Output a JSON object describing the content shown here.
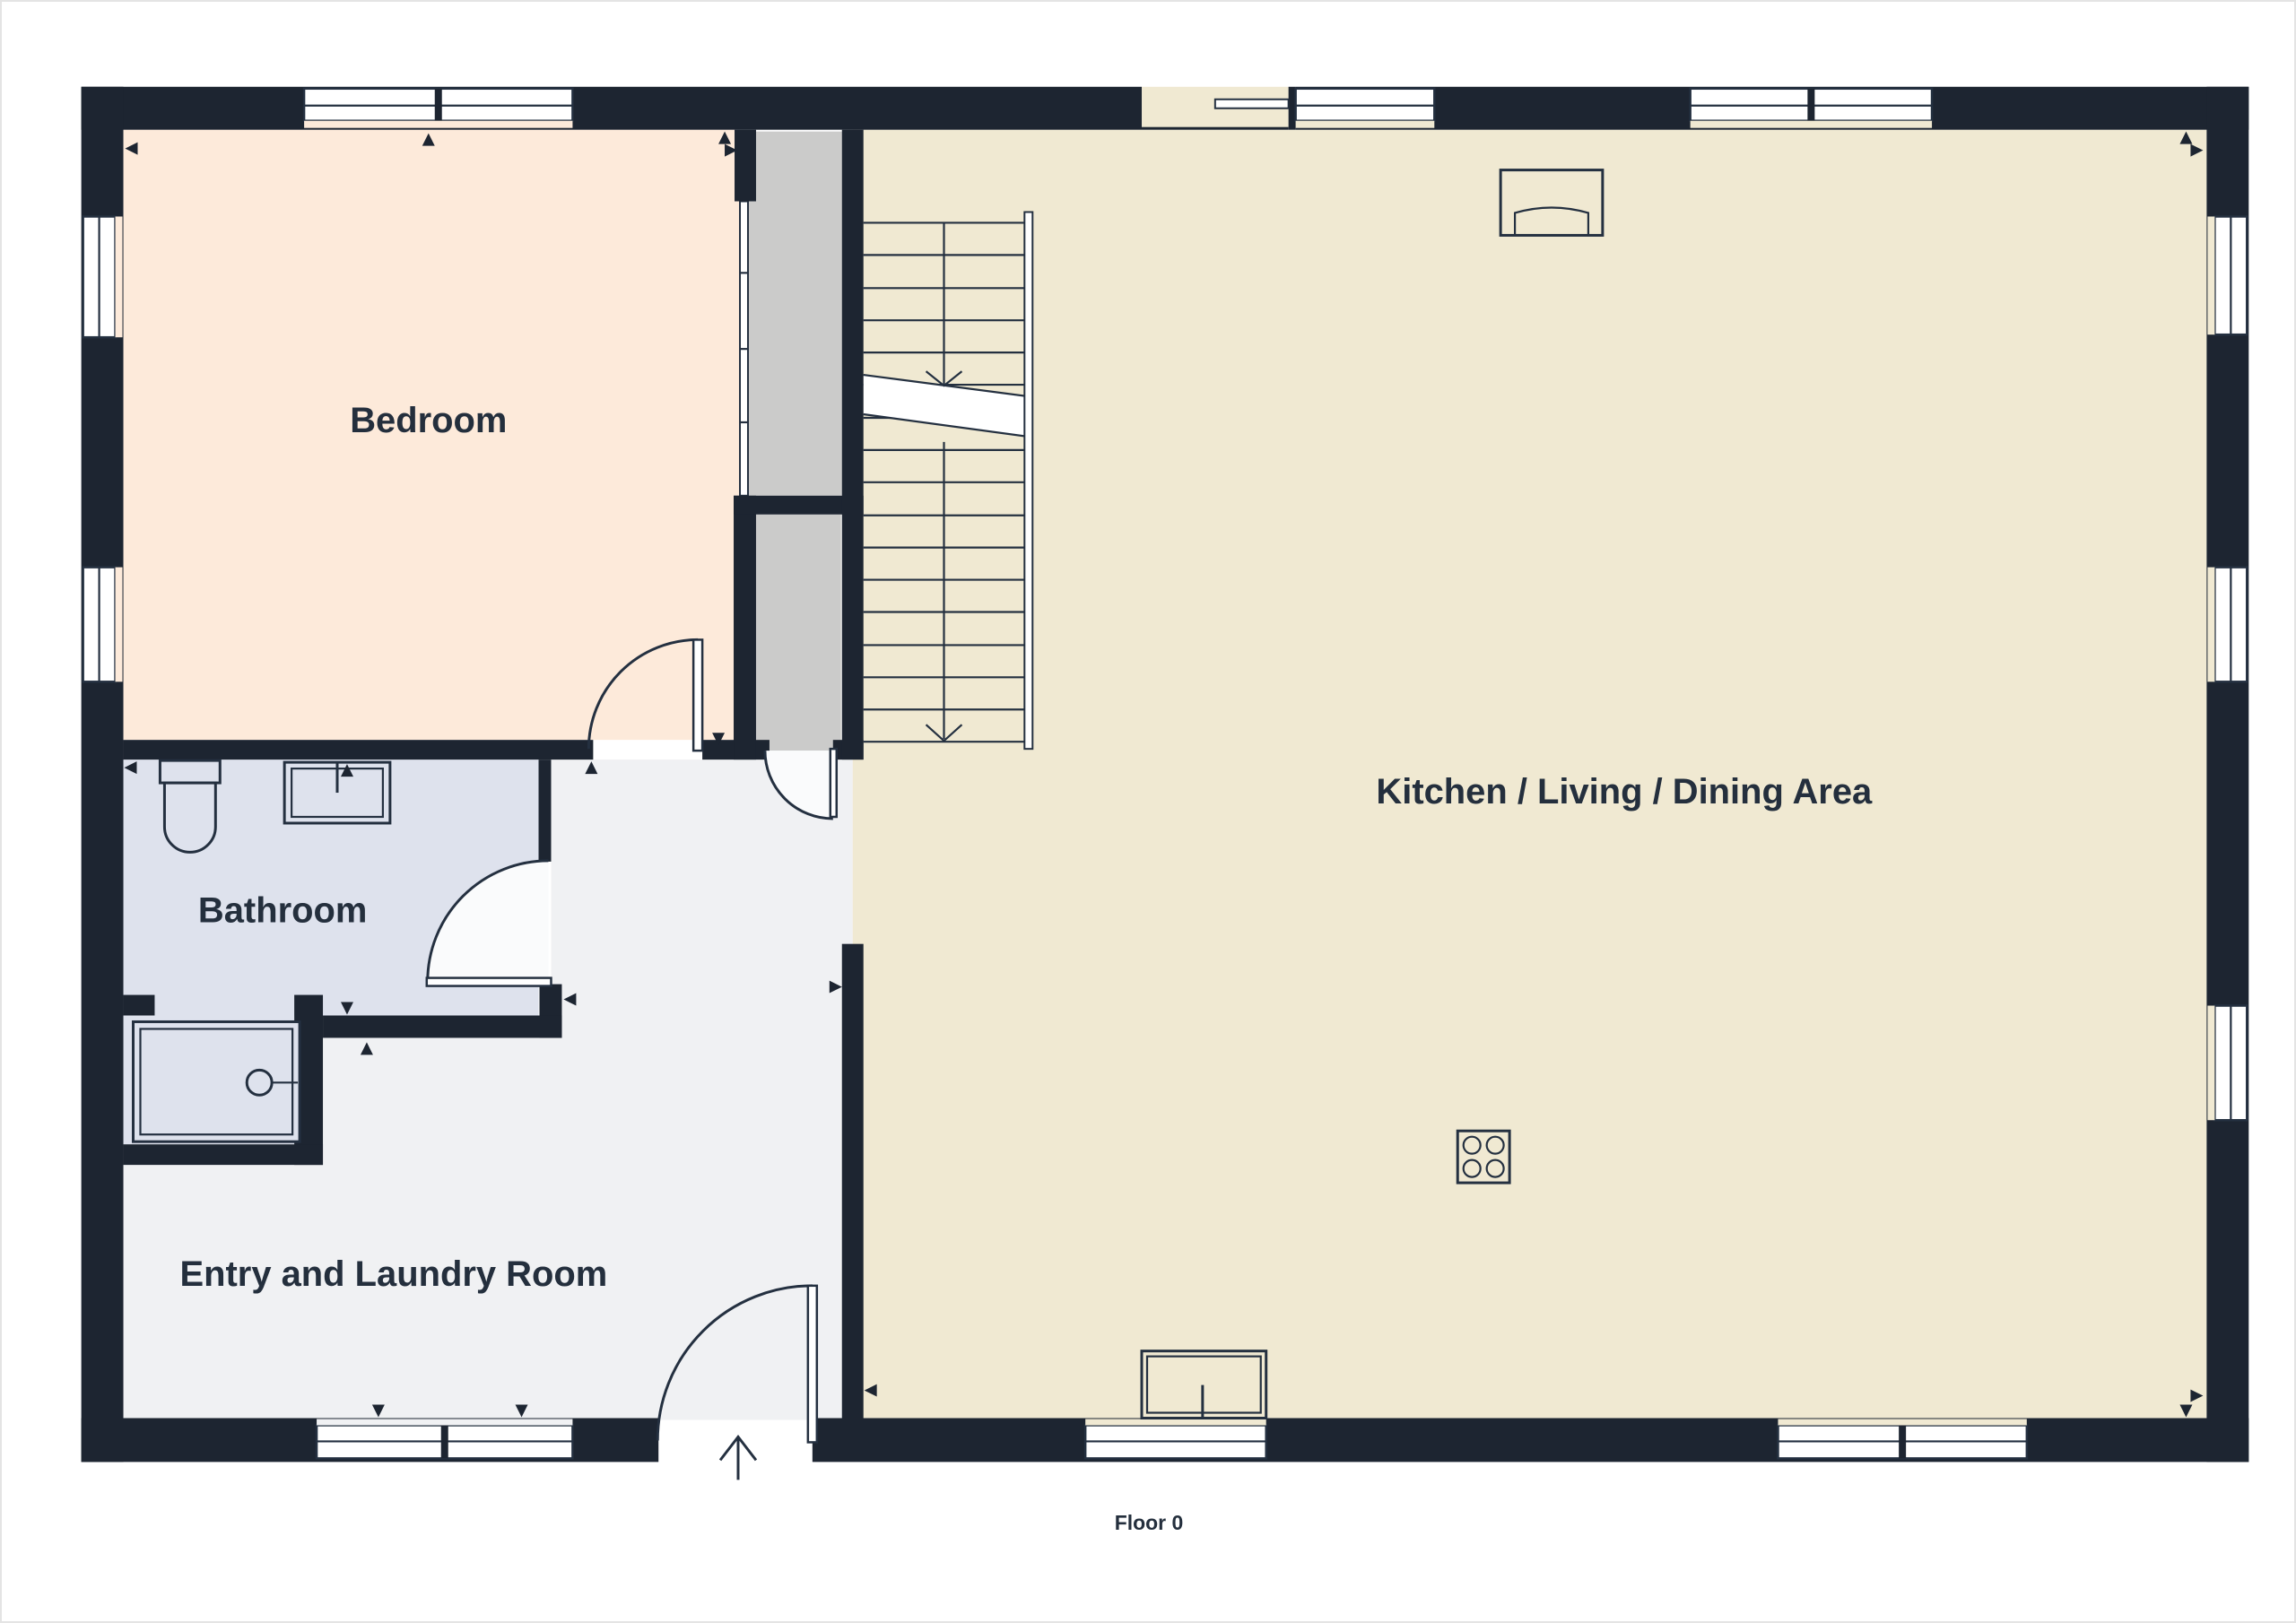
{
  "page": {
    "background": "#ffffff",
    "frame_color": "#e4e4e4"
  },
  "plan": {
    "floor_label": "Floor 0",
    "rooms": [
      {
        "name": "bedroom",
        "label": "Bedroom",
        "fill": "#fdeada"
      },
      {
        "name": "bathroom",
        "label": "Bathroom",
        "fill": "#dee2ed"
      },
      {
        "name": "entry-laundry",
        "label": "Entry and Laundry Room",
        "fill": "#f0f1f3"
      },
      {
        "name": "kitchen-living-dining",
        "label": "Kitchen / Living / Dining Area",
        "fill": "#f0e9d2"
      }
    ],
    "colors": {
      "wall": "#1d2531",
      "line": "#243040",
      "window_glass": "#ffffff",
      "closet": "#cbcbca",
      "label_text": "#242f3d",
      "arrow": "#1d2531",
      "door_swing": "#fafbfc"
    },
    "fixtures": [
      "toilet",
      "bathroom-sink",
      "shower",
      "wardrobe-sliding-doors",
      "staircase",
      "cooktop",
      "kitchen-sink",
      "counter-appliance",
      "entry-door",
      "bedroom-door",
      "bathroom-door",
      "hall-door",
      "sliding-panel",
      "windows",
      "entrance-arrow"
    ]
  }
}
